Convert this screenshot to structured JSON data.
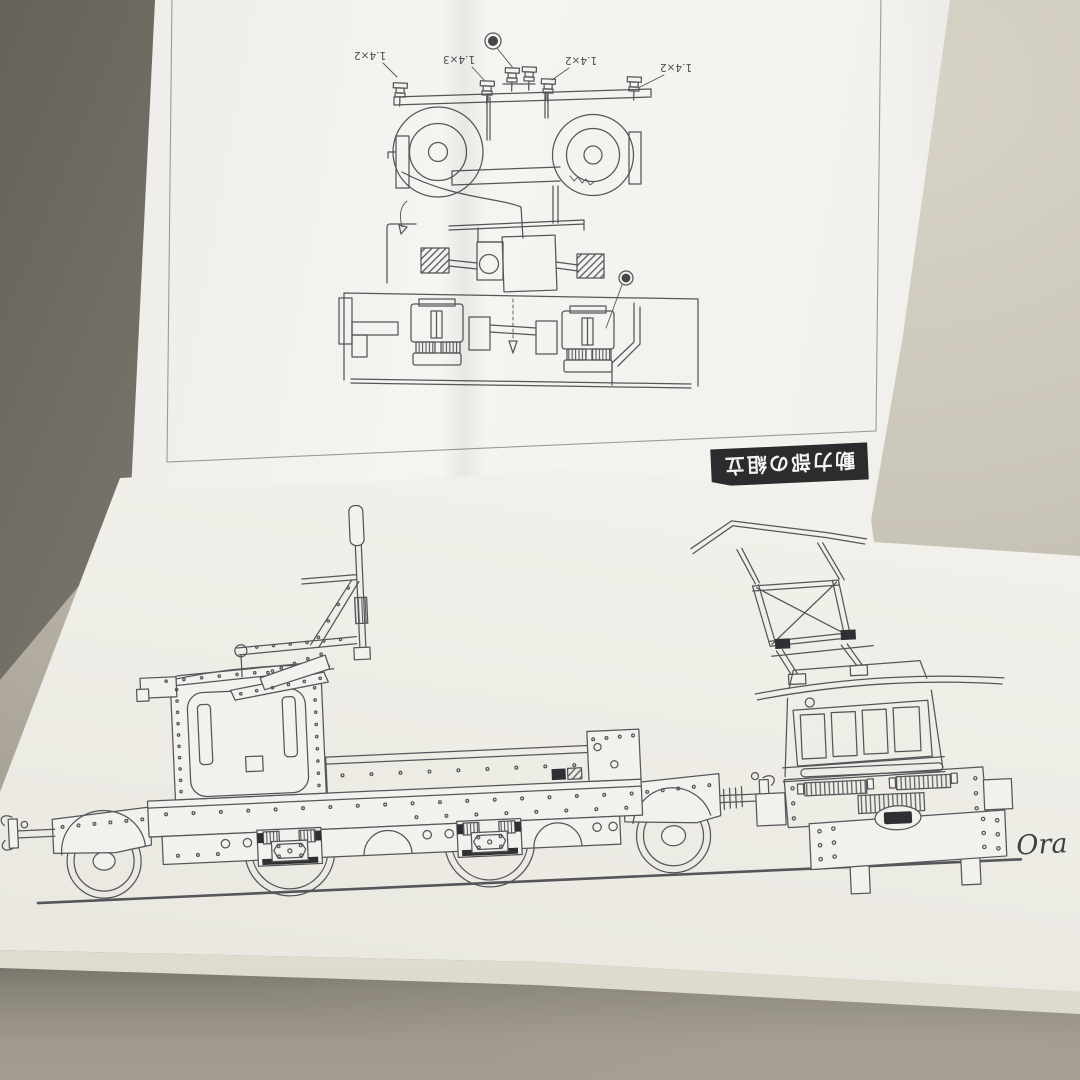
{
  "photo": {
    "upper_sheet": {
      "part_labels": [
        "1.4×2",
        "1.4×3",
        "1.4×2",
        "1.4×2"
      ],
      "section_label": "動力部の組立"
    },
    "lower_sheet": {
      "signature": "Ora"
    },
    "colors": {
      "ink": "#55565a",
      "paper_upper": "#f3f2ee",
      "paper_lower": "#f0efe9",
      "table": "#c8c2b6",
      "table_shadow": "#6f6b63",
      "label_bg": "#2b2c2e",
      "label_text": "#f3f3ef"
    }
  }
}
